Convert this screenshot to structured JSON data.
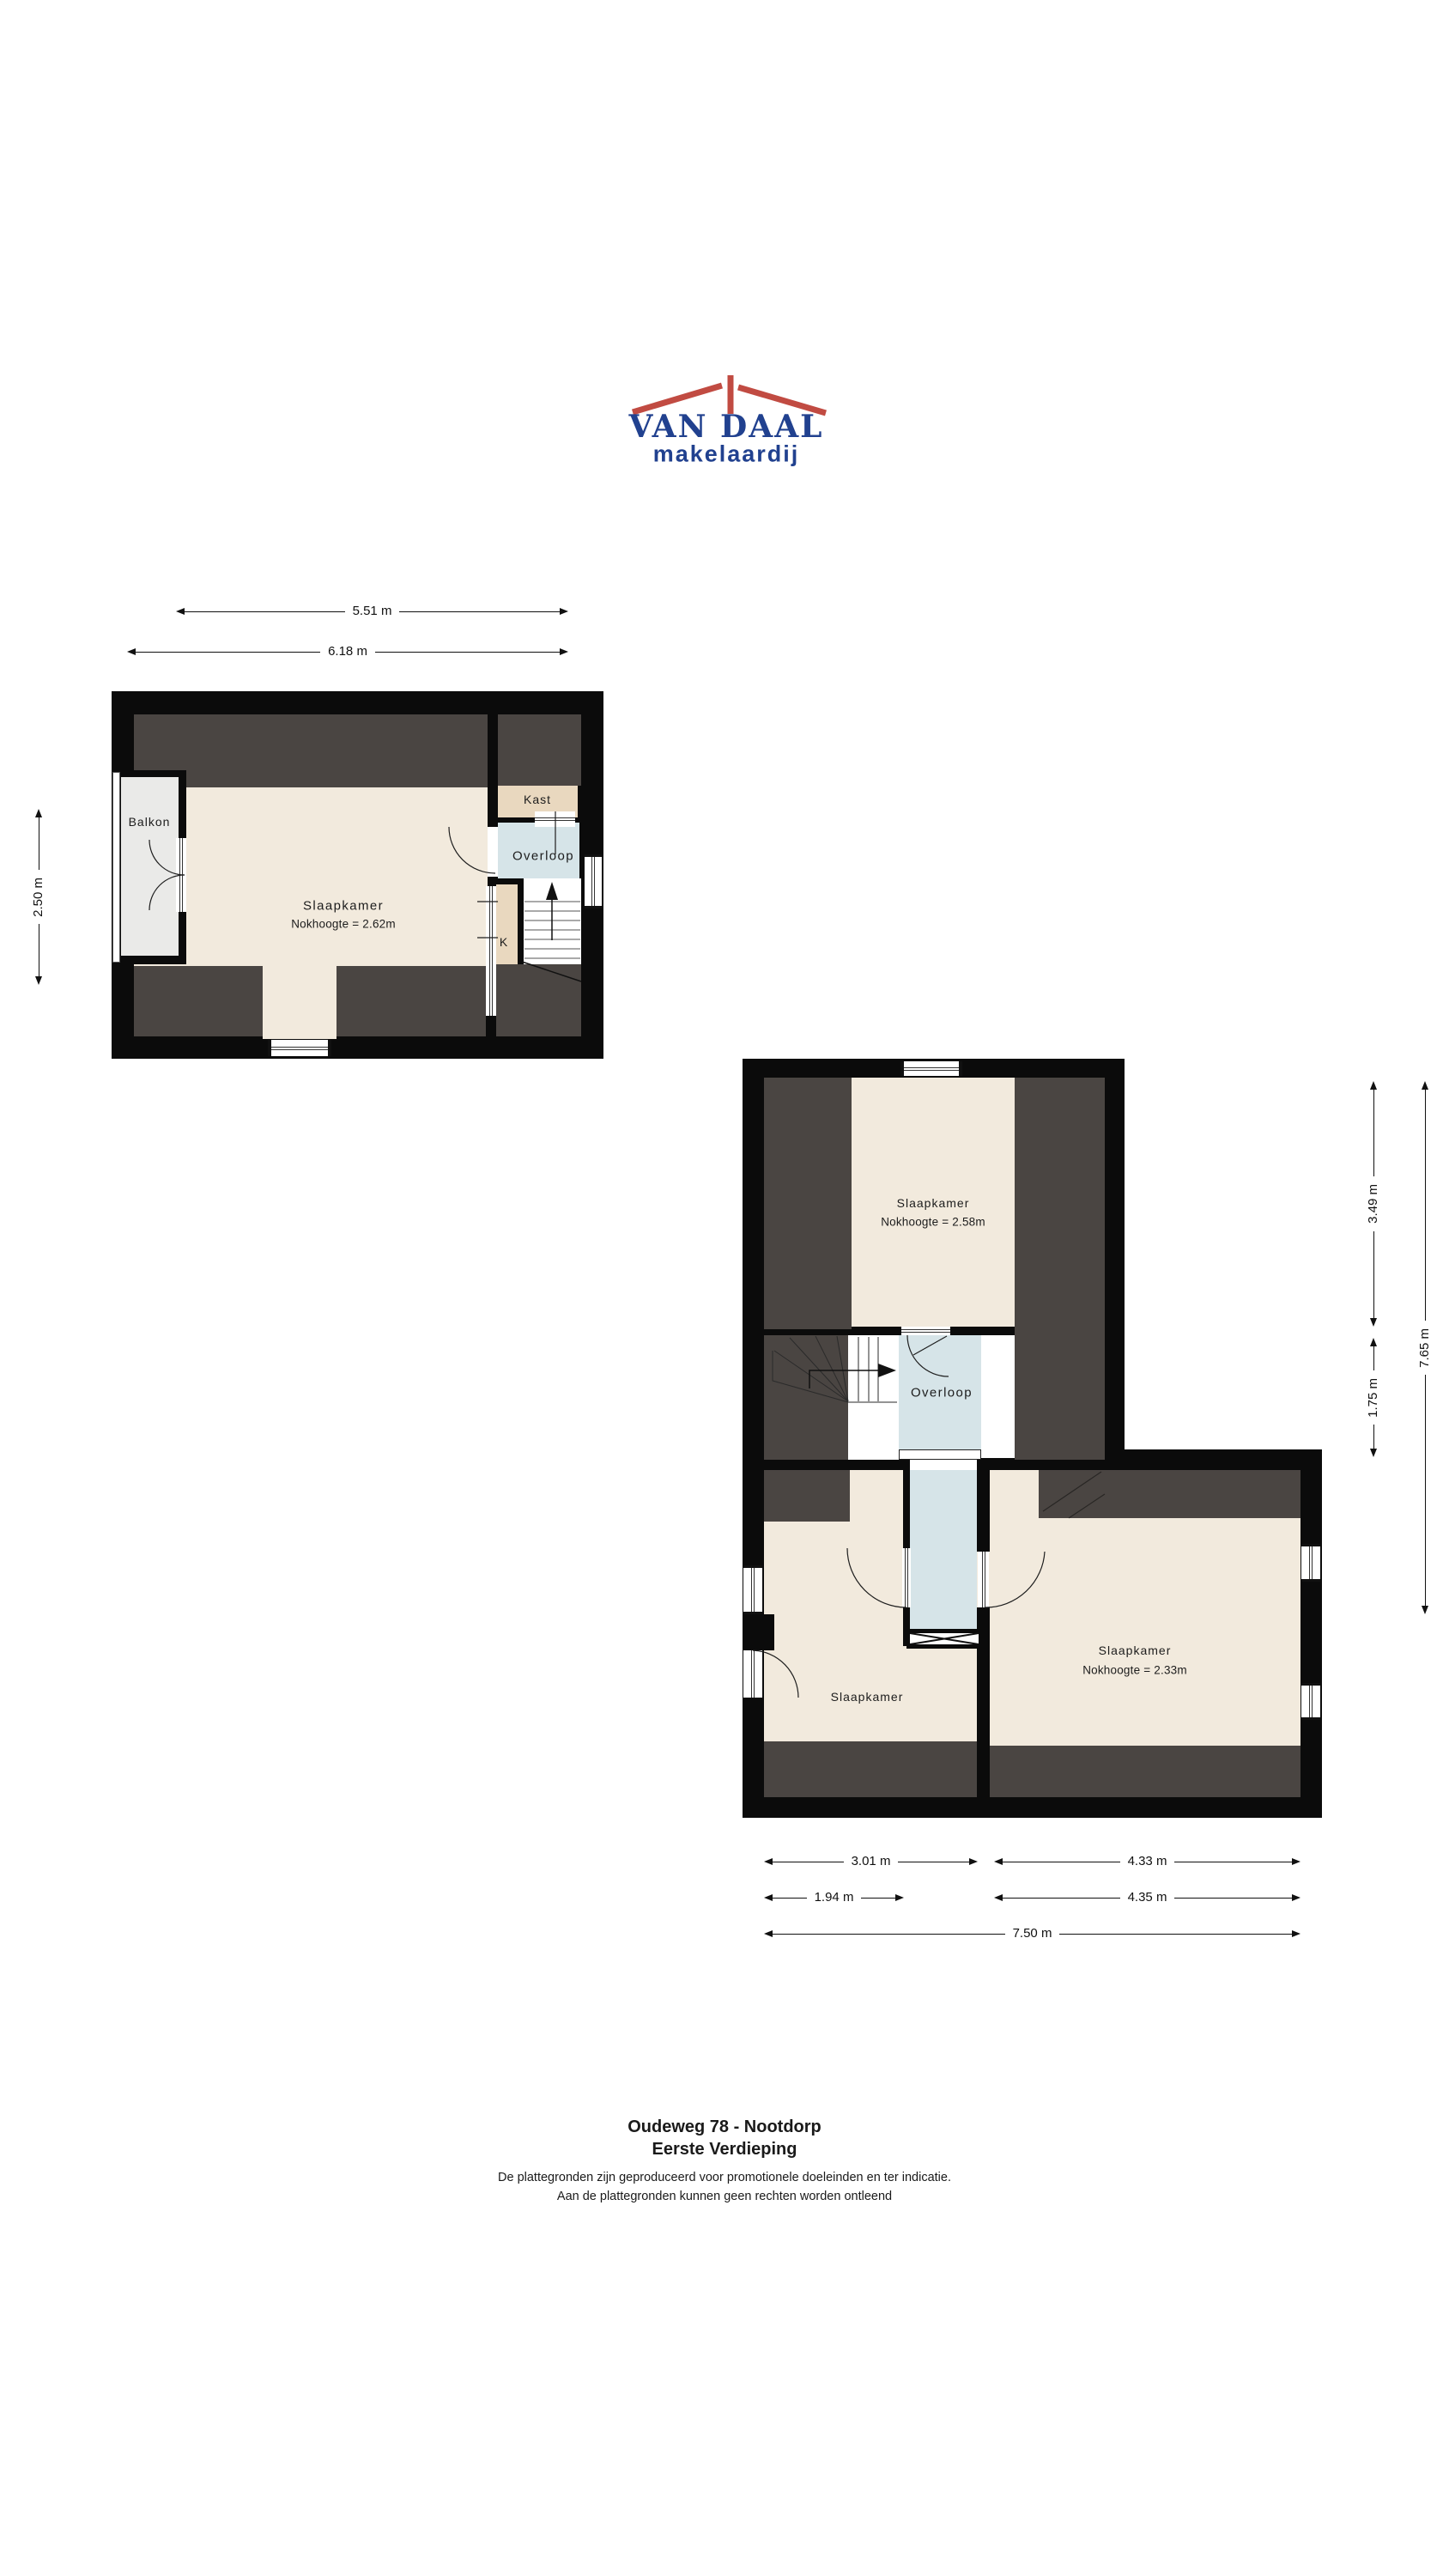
{
  "logo": {
    "name": "VAN DAAL",
    "tagline": "makelaardij"
  },
  "floor1": {
    "labels": {
      "balkon": "Balkon",
      "slaapkamer": "Slaapkamer",
      "slaapkamer_height": "Nokhoogte = 2.62m",
      "kast": "Kast",
      "overloop": "Overloop",
      "k": "K"
    },
    "dimensions": {
      "inner_width": "5.51 m",
      "outer_width": "6.18 m",
      "left_height": "2.50 m"
    }
  },
  "floor2": {
    "labels": {
      "slaapkamer_top": "Slaapkamer",
      "slaapkamer_top_height": "Nokhoogte = 2.58m",
      "overloop": "Overloop",
      "slaapkamer_left": "Slaapkamer",
      "slaapkamer_right": "Slaapkamer",
      "slaapkamer_right_height": "Nokhoogte = 2.33m"
    },
    "dimensions": {
      "right_top": "3.49 m",
      "right_mid": "1.75 m",
      "right_total": "7.65 m",
      "bottom_left_wide": "3.01 m",
      "bottom_right_wide": "4.33 m",
      "bottom_left_narrow": "1.94 m",
      "bottom_right_narrow": "4.35 m",
      "bottom_total": "7.50 m"
    }
  },
  "footer": {
    "address": "Oudeweg 78 - Nootdorp",
    "floor_name": "Eerste Verdieping",
    "disclaimer_line1": "De plattegronden zijn geproduceerd voor promotionele doeleinden en ter indicatie.",
    "disclaimer_line2": "Aan de plattegronden kunnen geen rechten worden ontleend"
  },
  "colors": {
    "wall": "#0b0b0b",
    "sloped": "#4a4542",
    "floor": "#f2eadd",
    "closet": "#e9d8bf",
    "hall": "#d6e4e8",
    "balcony": "#eaeae8",
    "logo_red": "#c14b42",
    "logo_blue": "#21418f"
  }
}
